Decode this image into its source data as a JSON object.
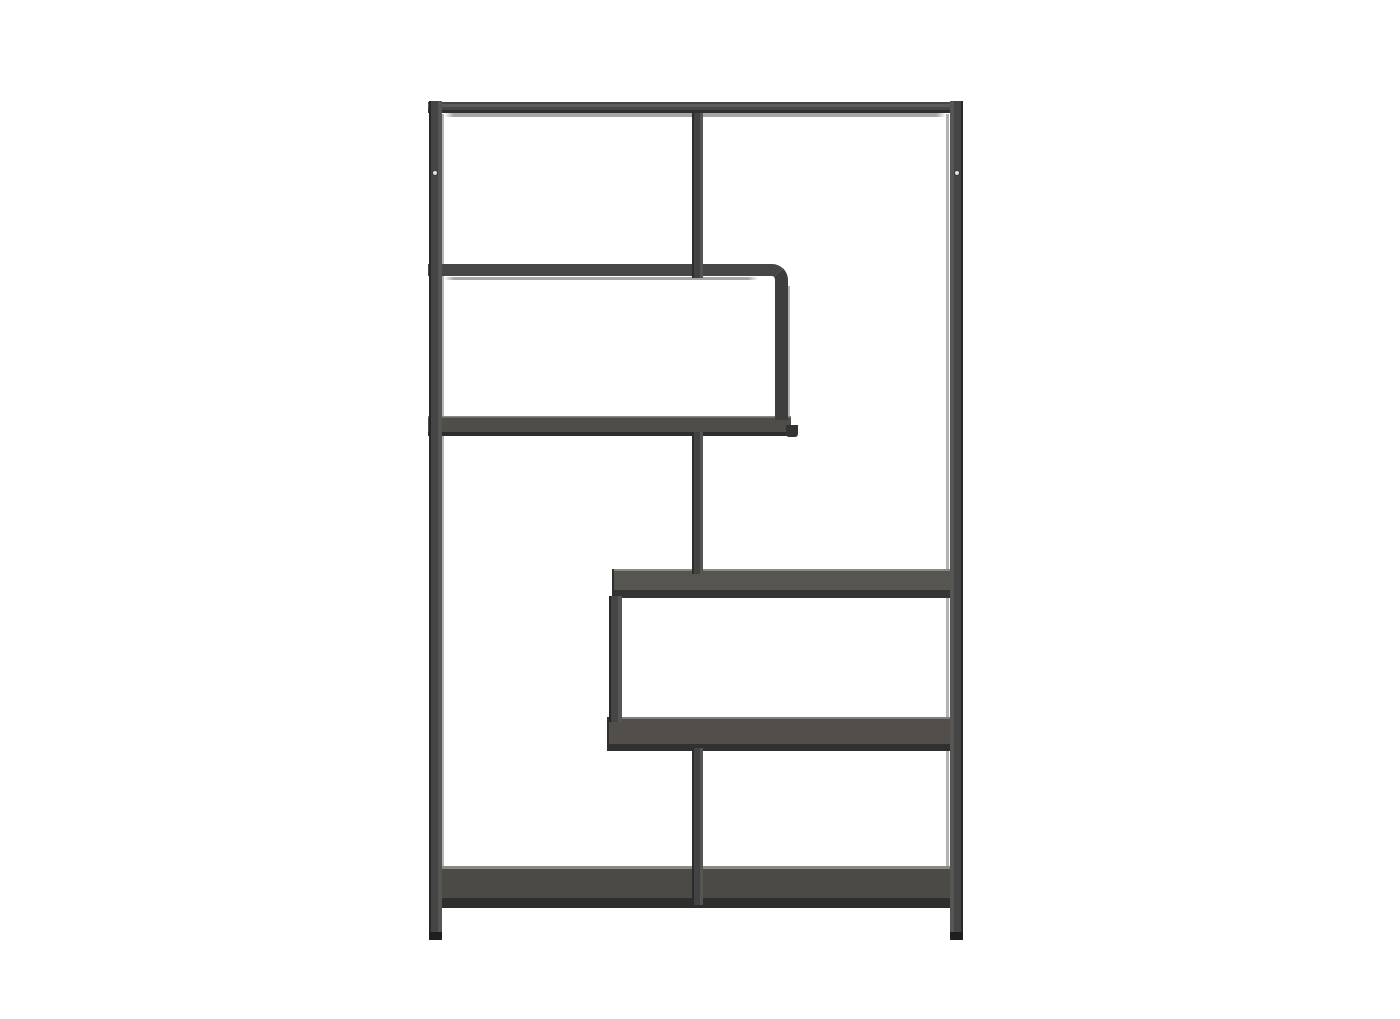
{
  "scene": {
    "type": "product-photo",
    "description": "Asymmetric black metal etagere bookcase with five staggered dark wood shelves, photographed on a plain white background",
    "background_color": "#ffffff",
    "colors": {
      "background": "#ffffff",
      "metal": "#454545",
      "metal_dark": "#333333",
      "metal_deep": "#262626",
      "metal_light": "#565654",
      "reflection": "#a6a6a4",
      "wood": "#524f4a",
      "wood_highlight": "#8a8881",
      "wood_shadow": "#2d2d2b",
      "screw": "#d9d9d7"
    },
    "parts": [
      "left-post",
      "right-post",
      "top-rail",
      "top-rail-reflection",
      "upper-divider",
      "upper-left-frame",
      "upper-left-frame-reflection",
      "upper-left-shelf",
      "shelf-end-bracket",
      "middle-divider",
      "middle-right-shelf",
      "mid-step-post",
      "lower-right-shelf",
      "lower-divider",
      "bottom-shelf",
      "left-foot",
      "right-foot",
      "left-screw-cap",
      "right-screw-cap"
    ]
  }
}
